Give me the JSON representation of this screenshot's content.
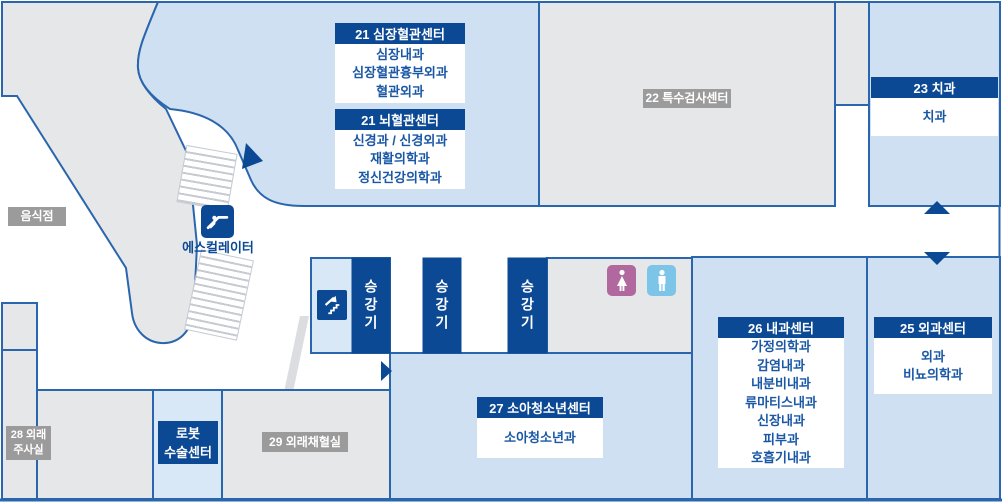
{
  "colors": {
    "dark_blue": "#0c4994",
    "border_blue": "#2a66ad",
    "light_blue": "#cfe0f2",
    "lighter_blue": "#d9e8f7",
    "area_gray": "#e6e7e9",
    "label_gray": "#9b9b9b",
    "text_blue": "#1a57a5",
    "female_icon_bg": "#b0689f",
    "male_icon_bg": "#7cc4e8"
  },
  "map": {
    "centers": {
      "cardiovascular": {
        "header": "21 심장혈관센터",
        "departments": [
          "심장내과",
          "심장혈관흉부외과",
          "혈관외과"
        ]
      },
      "cerebrovascular": {
        "header": "21 뇌혈관센터",
        "departments": [
          "신경과 / 신경외과",
          "재활의학과",
          "정신건강의학과"
        ]
      },
      "dental": {
        "header": "23 치과",
        "departments": [
          "치과"
        ]
      },
      "surgery": {
        "header": "25 외과센터",
        "departments": [
          "외과",
          "비뇨의학과"
        ]
      },
      "internal_medicine": {
        "header": "26 내과센터",
        "departments": [
          "가정의학과",
          "감염내과",
          "내분비내과",
          "류마티스내과",
          "신장내과",
          "피부과",
          "호흡기내과"
        ]
      },
      "pediatrics": {
        "header": "27 소아청소년센터",
        "departments": [
          "소아청소년과"
        ]
      }
    },
    "areas": {
      "restaurant": {
        "label": "음식점"
      },
      "special_exam_center": {
        "label": "22 특수검사센터"
      },
      "outpatient_injection_room": {
        "label_lines": [
          "28 외래",
          "주사실"
        ]
      },
      "robot_surgery_center": {
        "label_lines": [
          "로봇",
          "수술센터"
        ]
      },
      "outpatient_blood_room": {
        "label": "29 외래채혈실"
      }
    },
    "facilities": {
      "escalator": {
        "label": "에스컬레이터",
        "icon": "escalator-icon"
      },
      "elevator_1": {
        "label": "승강기"
      },
      "elevator_2": {
        "label": "승강기"
      },
      "elevator_3": {
        "label": "승강기"
      },
      "stairs": {
        "icon": "stairs-up-icon"
      },
      "restroom_female": {
        "icon": "female-restroom-icon"
      },
      "restroom_male": {
        "icon": "male-restroom-icon"
      },
      "direction_arrows": [
        "up-right-arrow-icon",
        "right-arrow-icon",
        "up-arrow-icon",
        "down-arrow-icon"
      ]
    }
  }
}
